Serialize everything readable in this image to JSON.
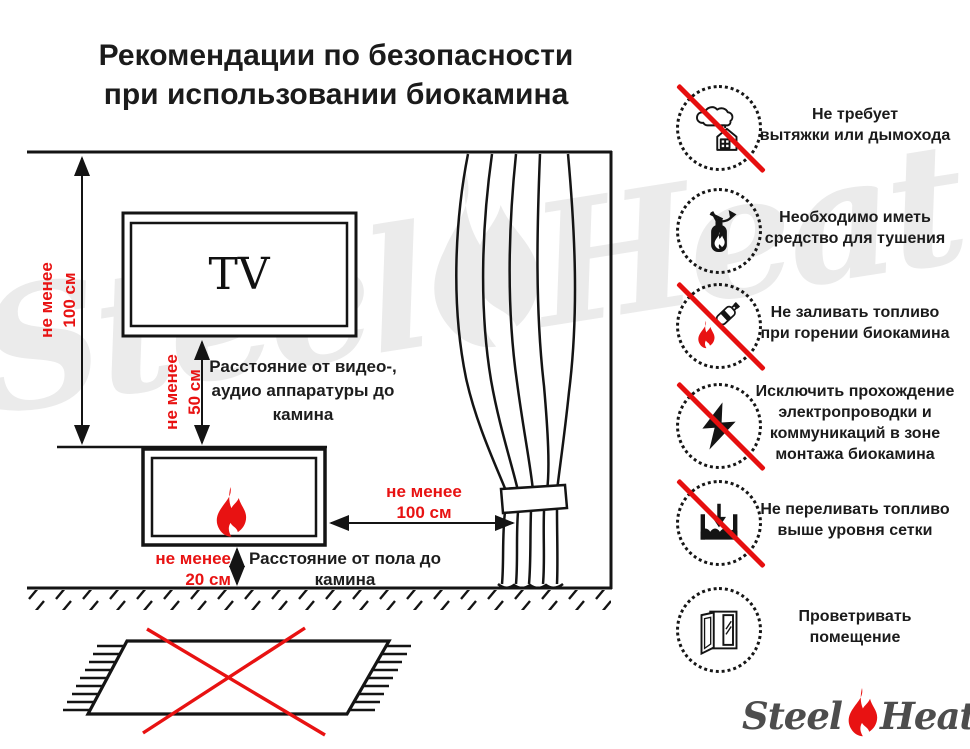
{
  "title": {
    "line1": "Рекомендации по безопасности",
    "line2": "при использовании биокамина"
  },
  "watermark": {
    "word1": "Steel",
    "word2": "Heat"
  },
  "logo": {
    "word1": "Steel",
    "word2": "Heat"
  },
  "diagram": {
    "tv_label": "TV",
    "dim_wall_tv": {
      "line1": "не менее",
      "line2": "100 см"
    },
    "dim_tv_fireplace": {
      "line1": "не менее",
      "line2": "50 см"
    },
    "dim_fireplace_curtain": {
      "line1": "не менее",
      "line2": "100 см"
    },
    "dim_fireplace_floor": {
      "line1": "не менее",
      "line2": "20 см"
    },
    "label_av": [
      "Расстояние от видео-,",
      "аудио аппаратуры до",
      "камина"
    ],
    "label_floor": [
      "Расстояние от пола до",
      "камина"
    ]
  },
  "rules": [
    {
      "icon": "no-chimney-icon",
      "prohibited": true,
      "lines": [
        "Не требует",
        "вытяжки или дымохода"
      ]
    },
    {
      "icon": "extinguisher-icon",
      "prohibited": false,
      "lines": [
        "Необходимо иметь",
        "средство для тушения"
      ]
    },
    {
      "icon": "no-refuel-while-burning-icon",
      "prohibited": true,
      "lines": [
        "Не заливать топливо",
        "при горении биокамина"
      ]
    },
    {
      "icon": "no-wiring-icon",
      "prohibited": true,
      "lines": [
        "Исключить прохождение",
        "электропроводки и",
        "коммуникаций в зоне",
        "монтажа биокамина"
      ]
    },
    {
      "icon": "no-overfill-icon",
      "prohibited": true,
      "lines": [
        "Не переливать топливо",
        "выше уровня сетки"
      ]
    },
    {
      "icon": "ventilate-icon",
      "prohibited": false,
      "lines": [
        "Проветривать",
        "помещение"
      ]
    }
  ],
  "colors": {
    "accent_red": "#e81212",
    "ink": "#141414",
    "watermark_gray": "#ebebeb",
    "logo_gray": "#4d4d4d"
  }
}
